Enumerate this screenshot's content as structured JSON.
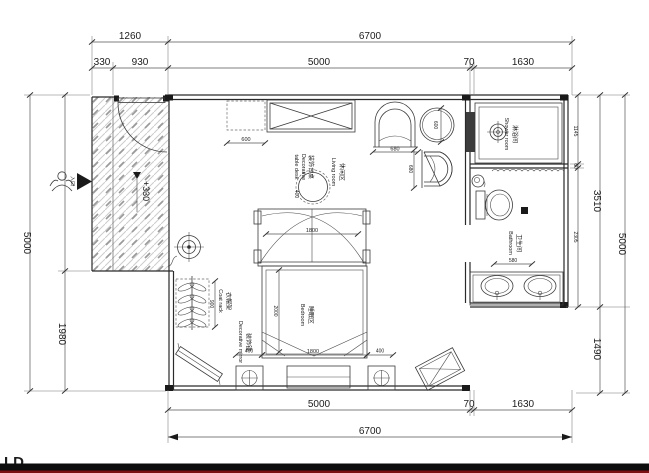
{
  "watermark": "LD",
  "level_marker": "+330",
  "entry_label": "入口",
  "dims": {
    "top": {
      "d1260": "1260",
      "d6700": "6700",
      "d330": "330",
      "d930": "930",
      "d5000": "5000",
      "d70": "70",
      "d1630": "1630"
    },
    "bottom": {
      "d5000": "5000",
      "d70": "70",
      "d1630": "1630",
      "d6700": "6700"
    },
    "left": {
      "d5000": "5000",
      "d1980": "1980"
    },
    "right": {
      "d1145": "1145",
      "d60": "60",
      "d2305": "2305",
      "d3510": "3510",
      "d1490": "1490",
      "d5000": "5000"
    }
  },
  "rooms": {
    "living_cn": "休闲区",
    "living_en": "Living room",
    "bedroom_cn": "睡眠区",
    "bedroom_en": "Bedroom",
    "shower_cn": "淋浴间",
    "shower_en": "Shower room",
    "bathroom_cn": "卫生间",
    "bathroom_en": "Bathroom"
  },
  "furniture": {
    "coatrack_cn": "衣帽架",
    "coatrack_en": "Coat rack",
    "mirror_cn": "装饰镜",
    "mirror_en": "Decorative mirror",
    "table_cn": "装饰台桌",
    "table_en1": "Decorative",
    "table_en2": "table desk"
  },
  "inner_dims": {
    "cabinet": "600",
    "chair_w": "680",
    "chair_h": "680",
    "side_table": "600",
    "canopy": "1800",
    "bed_len": "2000",
    "bed_w": "1800",
    "nightstand_l": "400",
    "nightstand_r": "400",
    "coatrack": "900",
    "vanity": "580",
    "table_offset": "400"
  }
}
